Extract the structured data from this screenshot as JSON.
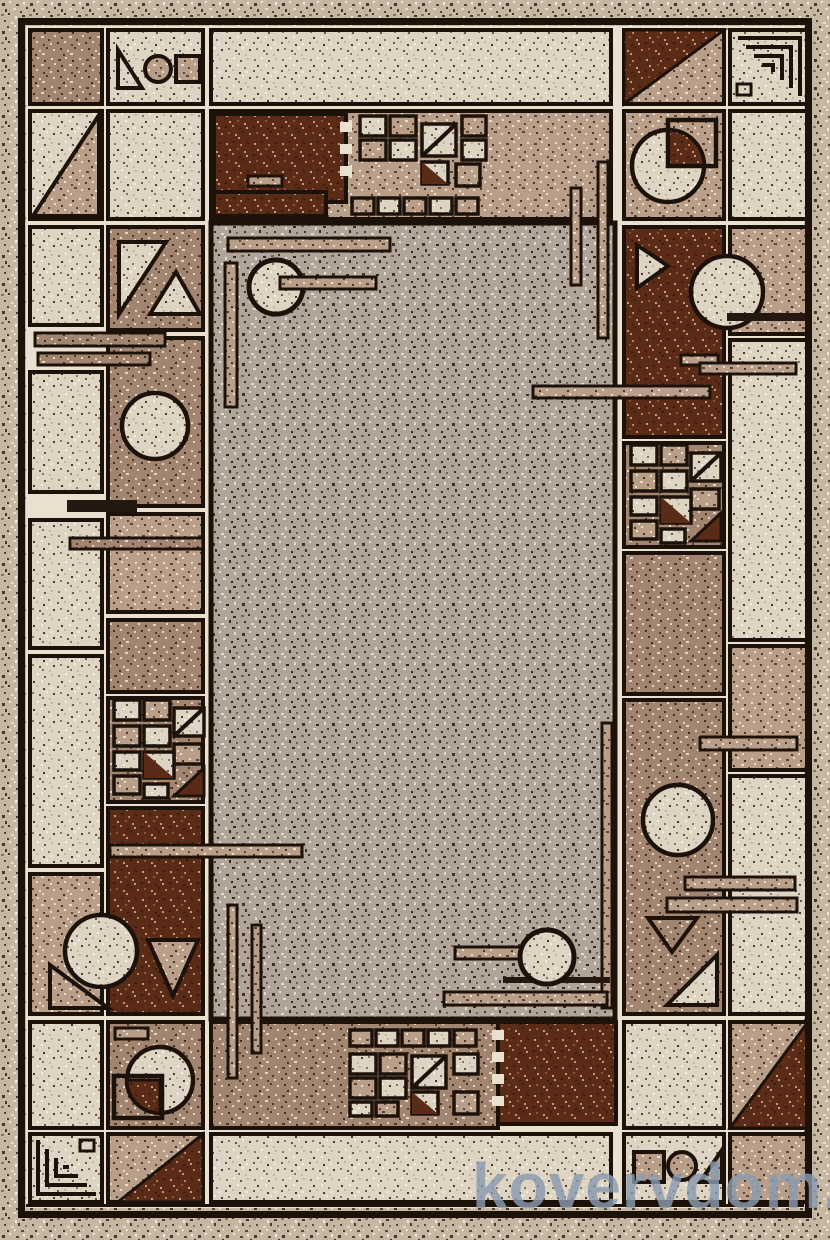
{
  "image": {
    "subject": "top-down product photo of a rectangular area rug",
    "style": "beige-brown art-deco geometric rug: gridded border of cells with triangles, circles, quarter-circle pies, nested corner lines, mosaic squares and crossing bars around a plain speckled taupe center field"
  },
  "watermark": {
    "text": "kovervdom.ru",
    "color": "#8a9bb0"
  },
  "palette": {
    "margin": "#c6b7a4",
    "gap_cream": "#e9e0cf",
    "cell_cream": "#ddd4c3",
    "cell_tan": "#b99f8a",
    "cell_rosy_brown": "#a18570",
    "cell_dark_brown": "#5a2c17",
    "field_taupe": "#b1a498",
    "outline_black": "#1d120a"
  },
  "motifs": [
    "triangle-circle-square-icon",
    "diagonal-split-square-icon",
    "nested-corner-lines-icon",
    "quarter-pie-circle-icon",
    "mosaic-squares-icon",
    "crossing-bars-icon",
    "circle-on-brown-icon",
    "square-circle-triangle-icon"
  ]
}
